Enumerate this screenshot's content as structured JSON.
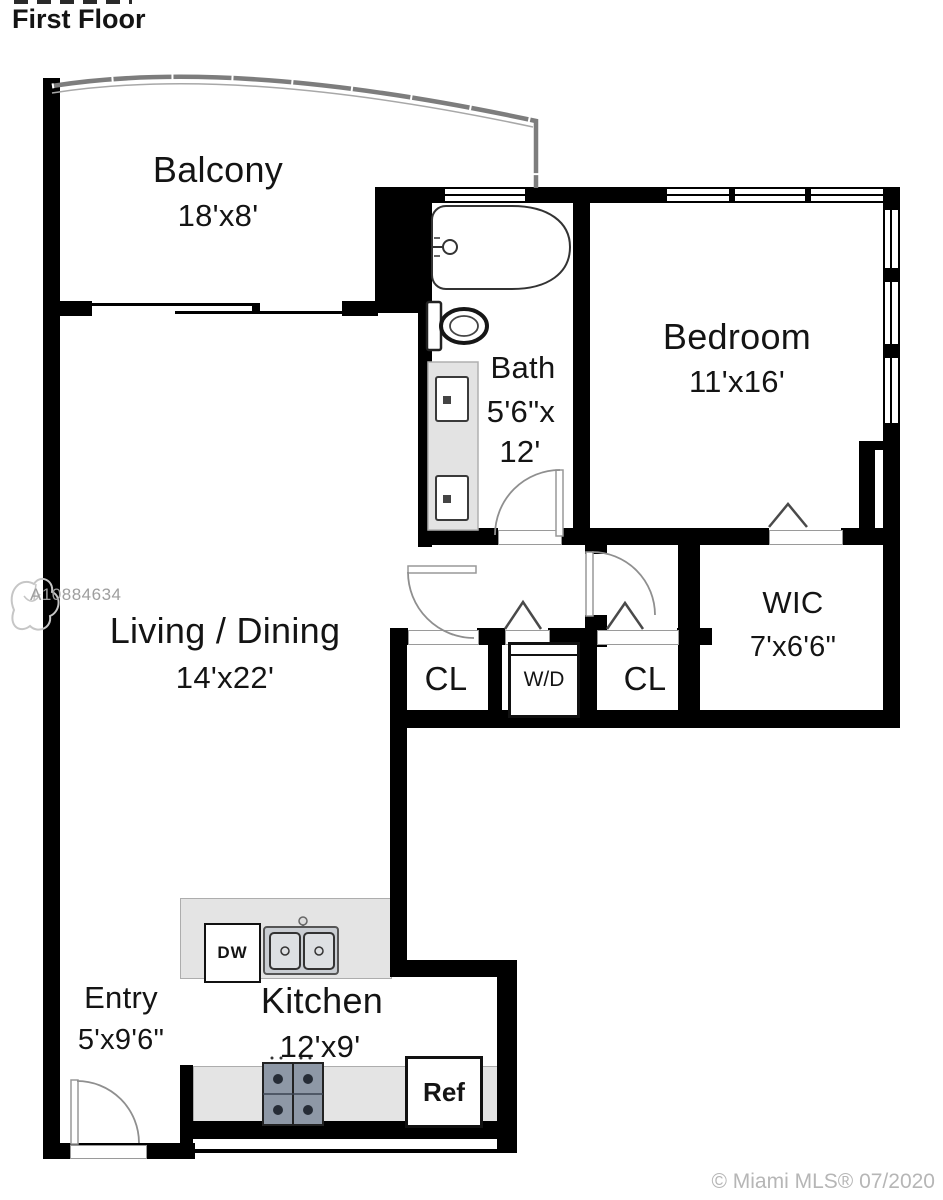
{
  "title": "First Floor",
  "rooms": {
    "balcony": {
      "name": "Balcony",
      "dims": "18'x8'"
    },
    "bath": {
      "name": "Bath",
      "dims1": "5'6\"x",
      "dims2": "12'"
    },
    "bedroom": {
      "name": "Bedroom",
      "dims": "11'x16'"
    },
    "living": {
      "name": "Living / Dining",
      "dims": "14'x22'"
    },
    "wic": {
      "name": "WIC",
      "dims": "7'x6'6\""
    },
    "closet_left": {
      "name": "CL"
    },
    "closet_right": {
      "name": "CL"
    },
    "kitchen": {
      "name": "Kitchen",
      "dims": "12'x9'"
    },
    "entry": {
      "name": "Entry",
      "dims": "5'x9'6\""
    }
  },
  "fixtures": {
    "washer_dryer": "W/D",
    "dishwasher": "DW",
    "refrigerator": "Ref"
  },
  "watermarks": {
    "mls_id": "A10884634",
    "copyright": "© Miami MLS® 07/2020"
  },
  "colors": {
    "wall": "#000000",
    "counter": "#e4e4e4",
    "stove": "#8e98a6",
    "watermark_gray": "#b6b6b6"
  }
}
